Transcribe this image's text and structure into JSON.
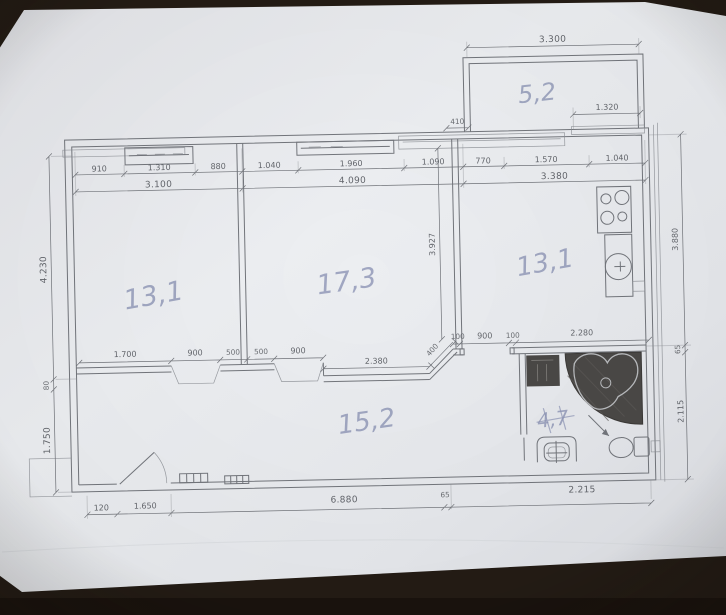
{
  "photo": {
    "table_color": "#241c15",
    "paper_color": "#e9ebef",
    "ink_color": "#72757b",
    "pencil_color": "#8b93b4",
    "shading_color": "#4b4947"
  },
  "floor_plan": {
    "room_labels": {
      "balcony": "5,2",
      "bedroom": "13,1",
      "living_room": "17,3",
      "kitchen": "13,1",
      "hall": "15,2",
      "bathroom": "4,7"
    },
    "dimensions": {
      "balcony_width": "3.300",
      "balcony_inner_width": "1.320",
      "balcony_wall_offset": "410",
      "top_segments": [
        "910",
        "1.310",
        "880",
        "1.040",
        "1.960",
        "1.090",
        "770",
        "1.570",
        "1.040"
      ],
      "top_totals": [
        "3.100",
        "4.090",
        "3.380"
      ],
      "left_heights": [
        "4.230",
        "80",
        "1.750"
      ],
      "middle_height": "3.927",
      "right_heights": [
        "3.880",
        "65",
        "2.115"
      ],
      "middle_segments": [
        "1.700",
        "900",
        "500",
        "500",
        "900",
        "2.380",
        "400",
        "100",
        "900",
        "100",
        "2.280"
      ],
      "bottom_segments": [
        "120",
        "1.650",
        "6.880",
        "65",
        "2.215"
      ]
    },
    "fixtures": [
      "stove-icon",
      "kitchen-sink-icon",
      "washer-icon",
      "corner-bathtub-icon",
      "toilet-icon",
      "washbasin-icon",
      "radiator-icon",
      "entry-door-icon"
    ]
  }
}
